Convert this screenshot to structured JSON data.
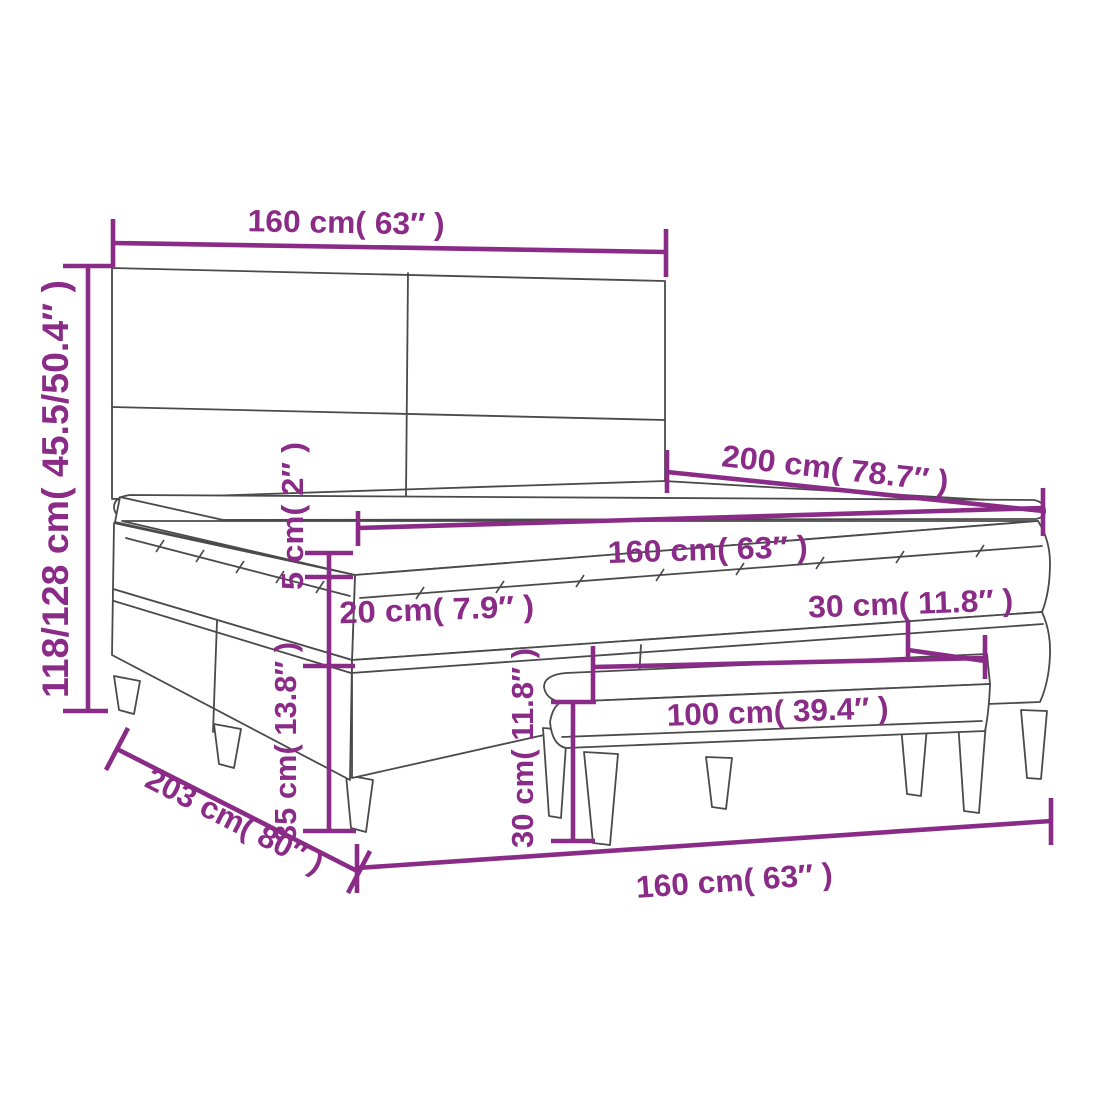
{
  "diagram": {
    "type": "product-dimension-diagram",
    "subject": "box spring bed with headboard, mattress topper and bench",
    "labels": {
      "headboard_width": "160 cm( 63″ )",
      "headboard_height": "118/128 cm( 45.5/50.4″ )",
      "bed_length_top": "200 cm( 78.7″ )",
      "mattress_width": "160 cm( 63″ )",
      "topper_height": "5 cm( 2″ )",
      "mattress_height": "20 cm( 7.9″ )",
      "base_height": "35 cm( 13.8″ )",
      "bed_length_floor": "203 cm( 80″ )",
      "bed_width_floor": "160 cm( 63″ )",
      "bench_width": "100 cm( 39.4″ )",
      "bench_depth": "30 cm( 11.8″ )",
      "bench_height": "30 cm( 11.8″ )"
    },
    "colors": {
      "dimension_text": "#8A2B87",
      "outline": "#4a4a4a",
      "background": "#ffffff"
    }
  }
}
